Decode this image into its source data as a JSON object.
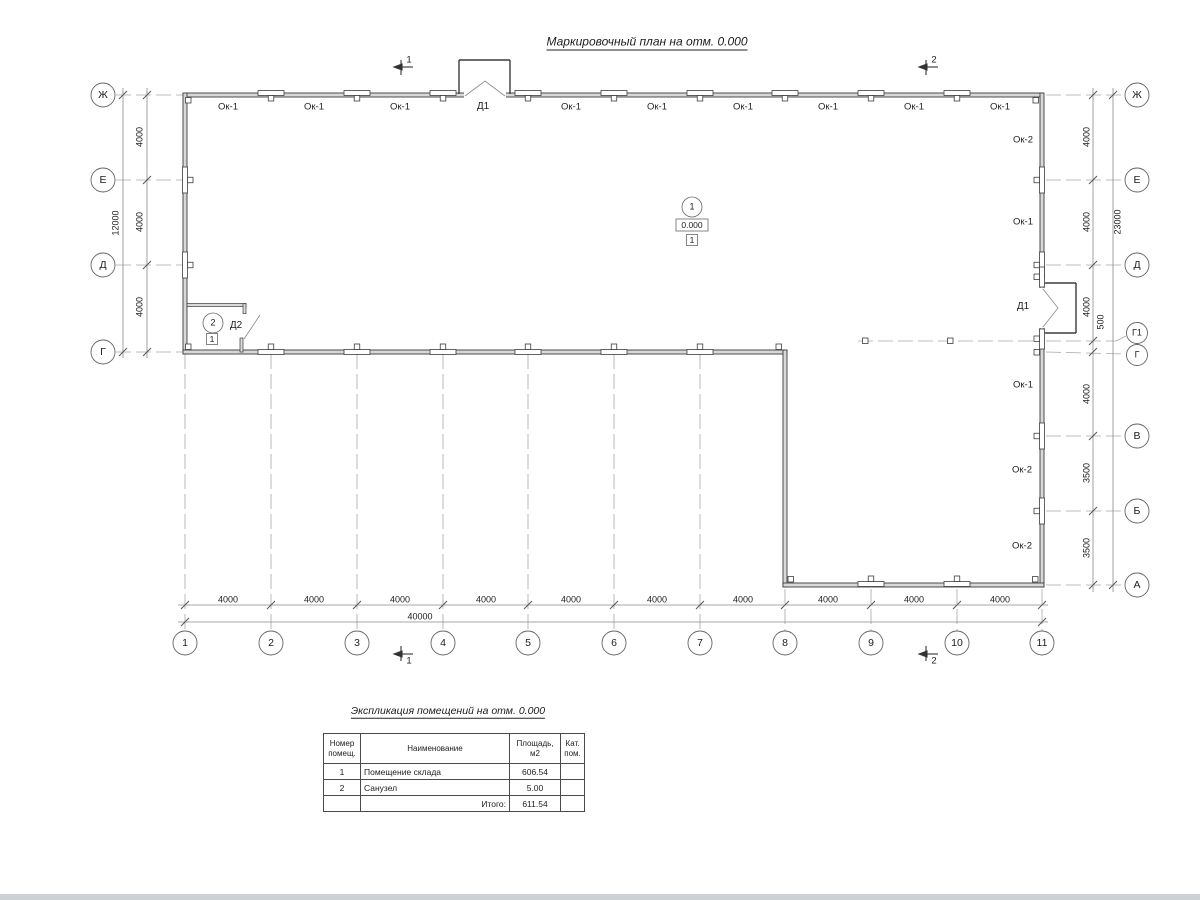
{
  "page_title": "Маркировочный план на отм. 0.000",
  "axes": {
    "left": [
      "Ж",
      "Е",
      "Д",
      "Г"
    ],
    "right": [
      "Ж",
      "Е",
      "Д",
      "Г1",
      "Г",
      "В",
      "Б",
      "А"
    ],
    "bottom": [
      "1",
      "2",
      "3",
      "4",
      "5",
      "6",
      "7",
      "8",
      "9",
      "10",
      "11"
    ]
  },
  "dims": {
    "left_segments": [
      "4000",
      "4000",
      "4000"
    ],
    "left_total": "12000",
    "right_segments": [
      "4000",
      "4000",
      "4000",
      "500",
      "4000",
      "3500",
      "3500"
    ],
    "right_total": "23000",
    "bottom_segments": [
      "4000",
      "4000",
      "4000",
      "4000",
      "4000",
      "4000",
      "4000",
      "4000",
      "4000",
      "4000"
    ],
    "bottom_total": "40000"
  },
  "openings": {
    "top_windows": [
      "Ок-1",
      "Ок-1",
      "Ок-1",
      "Ок-1",
      "Ок-1",
      "Ок-1",
      "Ок-1",
      "Ок-1",
      "Ок-1"
    ],
    "top_door": "Д1",
    "right_wall": [
      "Ок-2",
      "Ок-1",
      "Д1",
      "Ок-1",
      "Ок-2",
      "Ок-2"
    ],
    "interior_door": "Д2"
  },
  "section_cuts": {
    "cut1": "1",
    "cut2": "2"
  },
  "rooms": {
    "room1": {
      "number": "1",
      "elevation": "0.000",
      "floor_type": "1"
    },
    "room2": {
      "number": "2",
      "floor_type": "1"
    }
  },
  "table": {
    "title": "Экспликация помещений на отм. 0.000",
    "headers": [
      "Номер помещ.",
      "Наименование",
      "Площадь, м2",
      "Кат. пом."
    ],
    "rows": [
      {
        "num": "1",
        "name": "Помещение склада",
        "area": "606.54",
        "cat": ""
      },
      {
        "num": "2",
        "name": "Санузел",
        "area": "5.00",
        "cat": ""
      }
    ],
    "total_label": "Итого:",
    "total_value": "611.54"
  }
}
